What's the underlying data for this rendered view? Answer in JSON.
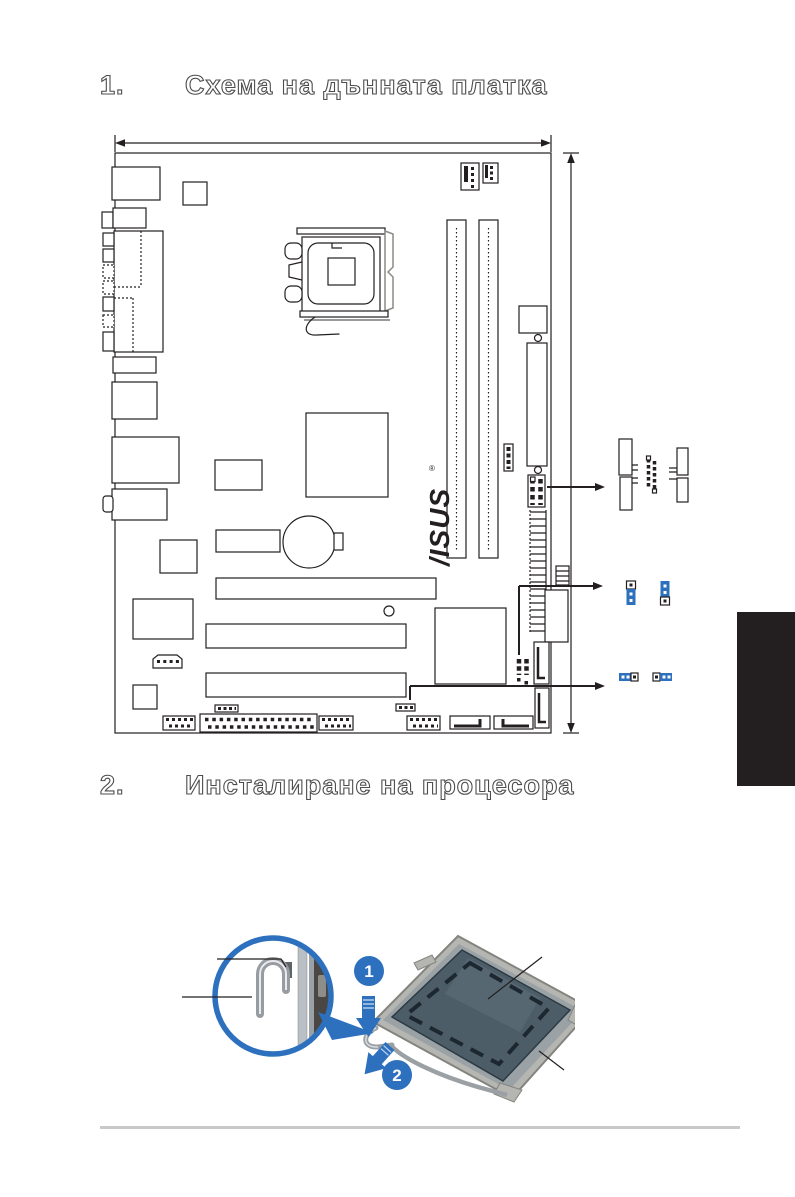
{
  "sections": [
    {
      "number": "1.",
      "title": "Схема на дънната платка"
    },
    {
      "number": "2.",
      "title": "Инсталиране на процесора"
    }
  ],
  "diagram": {
    "brand_logo": "/ISUS",
    "brand_reg": "®",
    "callouts": [
      "front-panel-connector-pinout",
      "3-pin-jumper-settings",
      "clear-rtc-jumper-settings"
    ]
  },
  "install": {
    "step1": "1",
    "step2": "2"
  },
  "colors": {
    "accent_blue": "#2c70be",
    "tab_black": "#231f20",
    "line_black": "#231f20",
    "footer_gray": "#c9c9c9",
    "socket_cover": "#4d5d68",
    "socket_metal": "#b5b5b1"
  }
}
